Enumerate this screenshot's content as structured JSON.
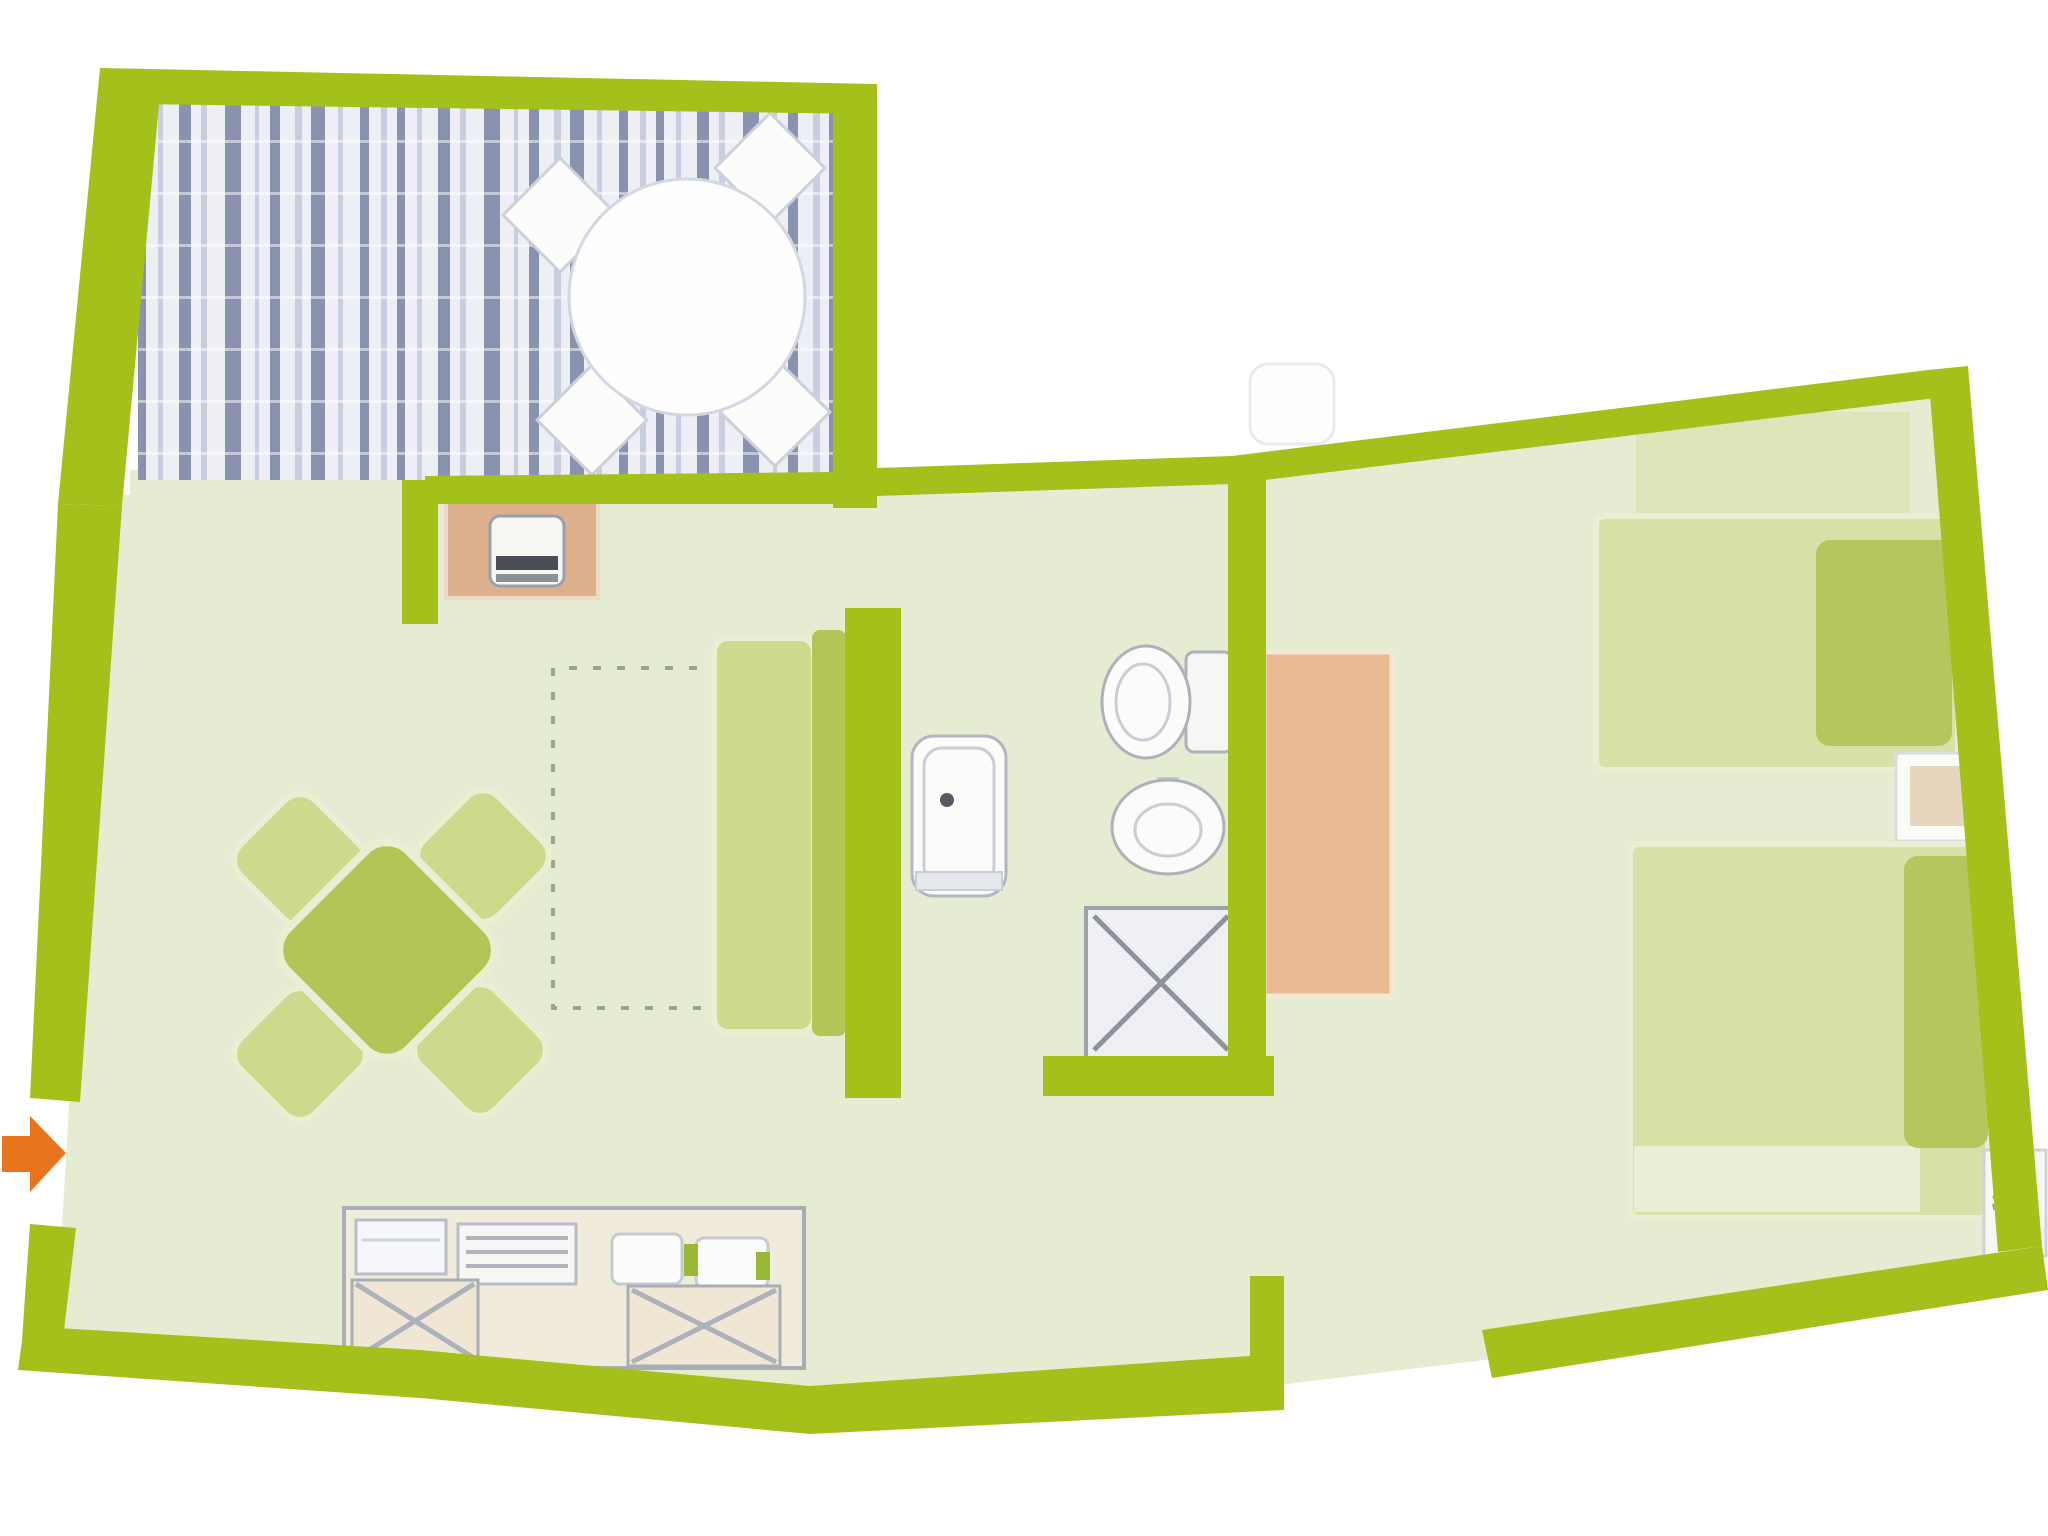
{
  "meta": {
    "description": "Hand-drawn style apartment floor plan, lime-green walls on white, pale green floors, blue striped wood terrace deck, orange entrance arrow at left",
    "canvas": {
      "width": 2048,
      "height": 1536
    }
  },
  "rooms": [
    "terrace",
    "living-dining-room",
    "kitchenette",
    "bathroom",
    "hallway",
    "bedroom"
  ],
  "colors": {
    "wall": "#a4c01b",
    "floor": "#e6ecd1",
    "deckBase": "#edeff5",
    "deckDark": "#6f7a9d",
    "deckMid": "#a9b2cd",
    "furnOlive": "#b4c456",
    "furnLight": "#cdd98d",
    "halo": "#e9efd2",
    "bedLight": "#d9e1a8",
    "bedFold": "#e9eed5",
    "pillow": "#b6c65c",
    "tanPanel": "#ddb08d",
    "wardrobe": "#e9ba92",
    "counterBase": "#f1ebdc",
    "cabinet": "#efe7d4",
    "grayDark": "#8e929c",
    "grayMid": "#adb1bb",
    "grayLight": "#c9cdd5",
    "white": "#fcfcfb",
    "orange": "#e8741e",
    "dash": "#9aa687"
  },
  "shapes": [
    {
      "name": "apartment-floor",
      "el": "polygon",
      "attrs": {
        "points": "130,470 860,470 860,480 1250,462 1945,378 2025,1252 1485,1360 1270,1386 805,1414 55,1344 105,495 130,495",
        "fill": "$floor"
      }
    },
    {
      "name": "terrace-decking",
      "el": "deck",
      "x": 138,
      "y": 92,
      "w": 700,
      "h": 388
    },
    {
      "name": "terrace-chair-top-left",
      "el": "polygon",
      "attrs": {
        "points": "560,158 617,215 560,272 503,215",
        "fill": "$white",
        "stroke": "#ccd0dc",
        "stroke-width": "3",
        "stroke-linejoin": "round"
      }
    },
    {
      "name": "terrace-chair-top-right",
      "el": "polygon",
      "attrs": {
        "points": "770,113 825,168 770,223 715,168",
        "fill": "$white",
        "stroke": "#ccd0dc",
        "stroke-width": "3",
        "stroke-linejoin": "round"
      }
    },
    {
      "name": "terrace-chair-bottom-left",
      "el": "polygon",
      "attrs": {
        "points": "592,365 647,420 592,475 537,420",
        "fill": "$white",
        "stroke": "#ccd0dc",
        "stroke-width": "3",
        "stroke-linejoin": "round"
      }
    },
    {
      "name": "terrace-chair-bottom-right",
      "el": "polygon",
      "attrs": {
        "points": "775,358 830,412 775,466 720,412",
        "fill": "$white",
        "stroke": "#ccd0dc",
        "stroke-width": "3",
        "stroke-linejoin": "round"
      }
    },
    {
      "name": "terrace-round-table",
      "el": "circle",
      "attrs": {
        "cx": "687",
        "cy": "297",
        "r": "118",
        "fill": "#fefefe",
        "stroke": "#d3d7e2",
        "stroke-width": "3"
      }
    },
    {
      "name": "dashed-recess-outline",
      "el": "path",
      "attrs": {
        "d": "M745 668 H553 V1008 H745",
        "fill": "none",
        "stroke": "$dash",
        "stroke-width": "4",
        "stroke-dasharray": "8 16"
      }
    },
    {
      "name": "stove-panel",
      "el": "rect",
      "attrs": {
        "x": "446",
        "y": "500",
        "width": "152",
        "height": "98",
        "fill": "$tanPanel",
        "stroke": "#ecd9c6",
        "stroke-width": "4"
      }
    },
    {
      "name": "stove-unit",
      "el": "rect",
      "attrs": {
        "x": "490",
        "y": "516",
        "width": "74",
        "height": "70",
        "rx": "10",
        "fill": "#f6f6f3",
        "stroke": "#9aa0ab",
        "stroke-width": "3"
      }
    },
    {
      "name": "stove-grate-dark",
      "el": "rect",
      "attrs": {
        "x": "496",
        "y": "556",
        "width": "62",
        "height": "14",
        "fill": "#4a4f57"
      }
    },
    {
      "name": "stove-grate-light",
      "el": "rect",
      "attrs": {
        "x": "496",
        "y": "574",
        "width": "62",
        "height": "8",
        "fill": "#8b9097"
      }
    },
    {
      "name": "dining-chair-top-left",
      "el": "rect",
      "attrs": {
        "x": "247",
        "y": "807",
        "width": "106",
        "height": "106",
        "rx": "22",
        "fill": "$furnLight",
        "stroke": "$halo",
        "stroke-width": "6",
        "transform": "rotate(45 300 860)"
      }
    },
    {
      "name": "dining-chair-top-right",
      "el": "rect",
      "attrs": {
        "x": "430",
        "y": "803",
        "width": "106",
        "height": "106",
        "rx": "22",
        "fill": "$furnLight",
        "stroke": "$halo",
        "stroke-width": "6",
        "transform": "rotate(45 483 856)"
      }
    },
    {
      "name": "dining-chair-bottom-left",
      "el": "rect",
      "attrs": {
        "x": "247",
        "y": "1001",
        "width": "106",
        "height": "106",
        "rx": "22",
        "fill": "$furnLight",
        "stroke": "$halo",
        "stroke-width": "6",
        "transform": "rotate(45 300 1054)"
      }
    },
    {
      "name": "dining-chair-bottom-right",
      "el": "rect",
      "attrs": {
        "x": "427",
        "y": "997",
        "width": "106",
        "height": "106",
        "rx": "22",
        "fill": "$furnLight",
        "stroke": "$halo",
        "stroke-width": "6",
        "transform": "rotate(45 480 1050)"
      }
    },
    {
      "name": "dining-table",
      "el": "rect",
      "attrs": {
        "x": "302",
        "y": "865",
        "width": "170",
        "height": "170",
        "rx": "30",
        "fill": "$furnOlive",
        "stroke": "$halo",
        "stroke-width": "8",
        "transform": "rotate(45 387 950)"
      }
    },
    {
      "name": "sofa-seat",
      "el": "rect",
      "attrs": {
        "x": "714",
        "y": "638",
        "width": "100",
        "height": "394",
        "rx": "14",
        "fill": "$furnLight",
        "stroke": "$halo",
        "stroke-width": "6"
      }
    },
    {
      "name": "sofa-back",
      "el": "rect",
      "attrs": {
        "x": "812",
        "y": "630",
        "width": "34",
        "height": "406",
        "rx": "8",
        "fill": "$furnOlive"
      }
    },
    {
      "name": "bathtub",
      "el": "rect",
      "attrs": {
        "x": "912",
        "y": "736",
        "width": "94",
        "height": "160",
        "rx": "22",
        "fill": "#fbfbf9",
        "stroke": "#b2b6c0",
        "stroke-width": "3"
      }
    },
    {
      "name": "bathtub-inner",
      "el": "rect",
      "attrs": {
        "x": "924",
        "y": "748",
        "width": "70",
        "height": "136",
        "rx": "18",
        "fill": "none",
        "stroke": "$grayLight",
        "stroke-width": "3"
      }
    },
    {
      "name": "bathtub-step",
      "el": "rect",
      "attrs": {
        "x": "916",
        "y": "872",
        "width": "86",
        "height": "18",
        "fill": "#e6e8ed",
        "stroke": "$grayLight",
        "stroke-width": "2"
      }
    },
    {
      "name": "bathtub-drain",
      "el": "circle",
      "attrs": {
        "cx": "947",
        "cy": "800",
        "r": "7",
        "fill": "#565b63"
      }
    },
    {
      "name": "toilet-tank",
      "el": "rect",
      "attrs": {
        "x": "1186",
        "y": "652",
        "width": "46",
        "height": "100",
        "rx": "8",
        "fill": "#f6f7f5",
        "stroke": "$grayMid",
        "stroke-width": "3"
      }
    },
    {
      "name": "toilet-bowl",
      "el": "ellipse",
      "attrs": {
        "cx": "1146",
        "cy": "702",
        "rx": "44",
        "ry": "56",
        "fill": "#fbfbf9",
        "stroke": "$grayMid",
        "stroke-width": "3"
      }
    },
    {
      "name": "toilet-bowl-inner",
      "el": "ellipse",
      "attrs": {
        "cx": "1143",
        "cy": "702",
        "rx": "27",
        "ry": "38",
        "fill": "none",
        "stroke": "$grayLight",
        "stroke-width": "3"
      }
    },
    {
      "name": "sink-faucet",
      "el": "rect",
      "attrs": {
        "x": "1157",
        "y": "777",
        "width": "22",
        "height": "14",
        "fill": "#c3c7cf"
      }
    },
    {
      "name": "sink-basin",
      "el": "ellipse",
      "attrs": {
        "cx": "1168",
        "cy": "827",
        "rx": "56",
        "ry": "47",
        "fill": "#fbfbf9",
        "stroke": "$grayMid",
        "stroke-width": "3"
      }
    },
    {
      "name": "sink-basin-inner",
      "el": "ellipse",
      "attrs": {
        "cx": "1168",
        "cy": "830",
        "rx": "33",
        "ry": "26",
        "fill": "none",
        "stroke": "$grayLight",
        "stroke-width": "3"
      }
    },
    {
      "name": "shower-tray",
      "el": "rect",
      "attrs": {
        "x": "1086",
        "y": "908",
        "width": "150",
        "height": "150",
        "fill": "#eef0f4",
        "stroke": "#9da1ab",
        "stroke-width": "4"
      }
    },
    {
      "name": "shower-cross-1",
      "el": "line",
      "attrs": {
        "x1": "1094",
        "y1": "916",
        "x2": "1228",
        "y2": "1050",
        "stroke": "$grayDark",
        "stroke-width": "5"
      }
    },
    {
      "name": "shower-cross-2",
      "el": "line",
      "attrs": {
        "x1": "1228",
        "y1": "916",
        "x2": "1094",
        "y2": "1050",
        "stroke": "$grayDark",
        "stroke-width": "5"
      }
    },
    {
      "name": "wardrobe",
      "el": "rect",
      "attrs": {
        "x": "1264",
        "y": "652",
        "width": "128",
        "height": "344",
        "fill": "$wardrobe",
        "stroke": "#f3e7d6",
        "stroke-width": "5"
      }
    },
    {
      "name": "bed-1-headboard-shade",
      "el": "rect",
      "attrs": {
        "x": "1636",
        "y": "412",
        "width": "274",
        "height": "108",
        "fill": "$bedLight",
        "opacity": "0.6"
      }
    },
    {
      "name": "bed-1-mattress",
      "el": "rect",
      "attrs": {
        "x": "1596",
        "y": "516",
        "width": "362",
        "height": "254",
        "rx": "8",
        "fill": "$bedLight",
        "stroke": "$halo",
        "stroke-width": "6"
      }
    },
    {
      "name": "bed-1-pillow",
      "el": "rect",
      "attrs": {
        "x": "1816",
        "y": "540",
        "width": "136",
        "height": "206",
        "rx": "14",
        "fill": "$pillow"
      }
    },
    {
      "name": "nightstand-between-beds",
      "el": "rect",
      "attrs": {
        "x": "1896",
        "y": "753",
        "width": "92",
        "height": "88",
        "fill": "#fbfbf8",
        "stroke": "#d9dce1",
        "stroke-width": "3"
      }
    },
    {
      "name": "nightstand-between-beds-top",
      "el": "rect",
      "attrs": {
        "x": "1910",
        "y": "766",
        "width": "58",
        "height": "60",
        "fill": "#e7d5bd"
      }
    },
    {
      "name": "bed-2-mattress",
      "el": "rect",
      "attrs": {
        "x": "1630",
        "y": "844",
        "width": "358",
        "height": "374",
        "rx": "8",
        "fill": "$bedLight",
        "stroke": "$halo",
        "stroke-width": "6"
      }
    },
    {
      "name": "bed-2-blanket-fold",
      "el": "rect",
      "attrs": {
        "x": "1634",
        "y": "1146",
        "width": "286",
        "height": "66",
        "fill": "$bedFold"
      }
    },
    {
      "name": "bed-2-pillow",
      "el": "rect",
      "attrs": {
        "x": "1904",
        "y": "856",
        "width": "84",
        "height": "292",
        "rx": "14",
        "fill": "$pillow"
      }
    },
    {
      "name": "corner-nightstand",
      "el": "rect",
      "attrs": {
        "x": "1984",
        "y": "1150",
        "width": "62",
        "height": "106",
        "fill": "#f7f7f3",
        "stroke": "#cdd1d8",
        "stroke-width": "3"
      }
    },
    {
      "name": "corner-nightstand-lamp",
      "el": "circle",
      "attrs": {
        "cx": "2014",
        "cy": "1202",
        "r": "20",
        "fill": "none",
        "stroke": "#9aa0aa",
        "stroke-width": "4",
        "stroke-dasharray": "6 5"
      }
    },
    {
      "name": "kitchen-counter",
      "el": "rect",
      "attrs": {
        "x": "344",
        "y": "1208",
        "width": "460",
        "height": "160",
        "fill": "$counterBase",
        "stroke": "#a9adb6",
        "stroke-width": "4"
      }
    },
    {
      "name": "kitchen-appliance-left",
      "el": "rect",
      "attrs": {
        "x": "356",
        "y": "1220",
        "width": "90",
        "height": "54",
        "fill": "#f4f6f9",
        "stroke": "#b9bdc7",
        "stroke-width": "3"
      }
    },
    {
      "name": "kitchen-appliance-left-line",
      "el": "line",
      "attrs": {
        "x1": "362",
        "y1": "1240",
        "x2": "440",
        "y2": "1240",
        "stroke": "#d0d5dd",
        "stroke-width": "3"
      }
    },
    {
      "name": "kitchen-appliance-mid",
      "el": "rect",
      "attrs": {
        "x": "458",
        "y": "1224",
        "width": "118",
        "height": "60",
        "fill": "#f7f7f5",
        "stroke": "#b9bdc7",
        "stroke-width": "3"
      }
    },
    {
      "name": "kitchen-appliance-mid-grill-1",
      "el": "line",
      "attrs": {
        "x1": "466",
        "y1": "1238",
        "x2": "568",
        "y2": "1238",
        "stroke": "#b0b5bf",
        "stroke-width": "4"
      }
    },
    {
      "name": "kitchen-appliance-mid-grill-2",
      "el": "line",
      "attrs": {
        "x1": "466",
        "y1": "1252",
        "x2": "568",
        "y2": "1252",
        "stroke": "#b0b5bf",
        "stroke-width": "4"
      }
    },
    {
      "name": "kitchen-appliance-mid-grill-3",
      "el": "line",
      "attrs": {
        "x1": "466",
        "y1": "1266",
        "x2": "568",
        "y2": "1266",
        "stroke": "#b0b5bf",
        "stroke-width": "4"
      }
    },
    {
      "name": "kitchen-sink-left",
      "el": "rect",
      "attrs": {
        "x": "612",
        "y": "1234",
        "width": "70",
        "height": "50",
        "rx": "8",
        "fill": "#fbfbf9",
        "stroke": "#c6cad2",
        "stroke-width": "3"
      }
    },
    {
      "name": "kitchen-sink-right",
      "el": "rect",
      "attrs": {
        "x": "696",
        "y": "1238",
        "width": "72",
        "height": "50",
        "rx": "8",
        "fill": "#fbfbf9",
        "stroke": "#c6cad2",
        "stroke-width": "3"
      }
    },
    {
      "name": "kitchen-faucet-accent",
      "el": "rect",
      "attrs": {
        "x": "684",
        "y": "1244",
        "width": "14",
        "height": "32",
        "fill": "#9ab838"
      }
    },
    {
      "name": "kitchen-plant-accent",
      "el": "rect",
      "attrs": {
        "x": "756",
        "y": "1252",
        "width": "14",
        "height": "28",
        "fill": "#9ab838"
      }
    },
    {
      "name": "kitchen-cabinet-left",
      "el": "rect",
      "attrs": {
        "x": "352",
        "y": "1280",
        "width": "126",
        "height": "82",
        "fill": "$cabinet",
        "stroke": "#a9adb6",
        "stroke-width": "3"
      }
    },
    {
      "name": "kitchen-cabinet-left-cross-1",
      "el": "line",
      "attrs": {
        "x1": "356",
        "y1": "1284",
        "x2": "474",
        "y2": "1358",
        "stroke": "$grayMid",
        "stroke-width": "5"
      }
    },
    {
      "name": "kitchen-cabinet-left-cross-2",
      "el": "line",
      "attrs": {
        "x1": "474",
        "y1": "1284",
        "x2": "356",
        "y2": "1358",
        "stroke": "$grayMid",
        "stroke-width": "5"
      }
    },
    {
      "name": "kitchen-cabinet-right",
      "el": "rect",
      "attrs": {
        "x": "628",
        "y": "1286",
        "width": "152",
        "height": "80",
        "fill": "$cabinet",
        "stroke": "#a9adb6",
        "stroke-width": "3"
      }
    },
    {
      "name": "kitchen-cabinet-right-cross-1",
      "el": "line",
      "attrs": {
        "x1": "632",
        "y1": "1290",
        "x2": "776",
        "y2": "1362",
        "stroke": "$grayMid",
        "stroke-width": "5"
      }
    },
    {
      "name": "kitchen-cabinet-right-cross-2",
      "el": "line",
      "attrs": {
        "x1": "776",
        "y1": "1290",
        "x2": "632",
        "y2": "1362",
        "stroke": "$grayMid",
        "stroke-width": "5"
      }
    },
    {
      "name": "exterior-mat",
      "el": "rect",
      "attrs": {
        "x": "1250",
        "y": "364",
        "width": "84",
        "height": "80",
        "rx": "18",
        "fill": "#fdfdfd",
        "stroke": "#e8eaef",
        "stroke-width": "3"
      }
    },
    {
      "name": "wall-terrace-left",
      "el": "polygon",
      "attrs": {
        "points": "100,68 162,72 122,506 58,504",
        "fill": "$wall"
      }
    },
    {
      "name": "wall-terrace-top",
      "el": "polygon",
      "attrs": {
        "points": "100,68 875,84 875,114 134,104",
        "fill": "$wall"
      }
    },
    {
      "name": "wall-terrace-right",
      "el": "polygon",
      "attrs": {
        "points": "833,84 877,84 877,508 833,508",
        "fill": "$wall"
      }
    },
    {
      "name": "wall-terrace-bottom",
      "el": "polygon",
      "attrs": {
        "points": "425,476 835,472 835,504 425,504",
        "fill": "$wall"
      }
    },
    {
      "name": "wall-terrace-bottom-stub",
      "el": "polygon",
      "attrs": {
        "points": "402,480 438,480 438,624 402,624",
        "fill": "$wall"
      }
    },
    {
      "name": "wall-living-top",
      "el": "polygon",
      "attrs": {
        "points": "877,468 1232,456 1232,484 877,496",
        "fill": "$wall"
      }
    },
    {
      "name": "wall-left-upper",
      "el": "polygon",
      "attrs": {
        "points": "58,504 122,506 80,1102 30,1098",
        "fill": "$wall"
      }
    },
    {
      "name": "wall-left-lower",
      "el": "polygon",
      "attrs": {
        "points": "30,1224 76,1228 62,1348 22,1340",
        "fill": "$wall"
      }
    },
    {
      "name": "wall-bottom",
      "el": "polygon",
      "attrs": {
        "points": "24,1326 420,1350 810,1386 1250,1356 1284,1356 1284,1410 810,1434 420,1398 18,1370",
        "fill": "$wall"
      }
    },
    {
      "name": "wall-bottom-door-stub",
      "el": "polygon",
      "attrs": {
        "points": "1250,1276 1284,1276 1284,1360 1250,1360",
        "fill": "$wall"
      }
    },
    {
      "name": "wall-bathroom-left",
      "el": "polygon",
      "attrs": {
        "points": "845,608 901,608 901,1098 845,1098",
        "fill": "$wall"
      }
    },
    {
      "name": "wall-bathroom-bottom",
      "el": "polygon",
      "attrs": {
        "points": "1043,1056 1274,1056 1274,1096 1043,1096",
        "fill": "$wall"
      }
    },
    {
      "name": "wall-bathroom-bedroom-divider",
      "el": "polygon",
      "attrs": {
        "points": "1228,474 1266,474 1266,1060 1228,1060",
        "fill": "$wall"
      }
    },
    {
      "name": "wall-bedroom-top",
      "el": "polygon",
      "attrs": {
        "points": "1232,456 1928,370 1936,398 1232,484",
        "fill": "$wall"
      }
    },
    {
      "name": "wall-bedroom-right",
      "el": "polygon",
      "attrs": {
        "points": "1928,370 1968,366 2042,1246 1998,1252",
        "fill": "$wall"
      }
    },
    {
      "name": "wall-bedroom-bottom",
      "el": "polygon",
      "attrs": {
        "points": "1482,1330 2042,1246 2048,1290 1492,1378",
        "fill": "$wall"
      }
    },
    {
      "name": "entrance-arrow",
      "el": "path",
      "attrs": {
        "d": "M2 1136 L30 1136 L30 1116 L66 1153 L30 1192 L30 1172 L2 1172 Z",
        "fill": "$orange"
      }
    }
  ]
}
